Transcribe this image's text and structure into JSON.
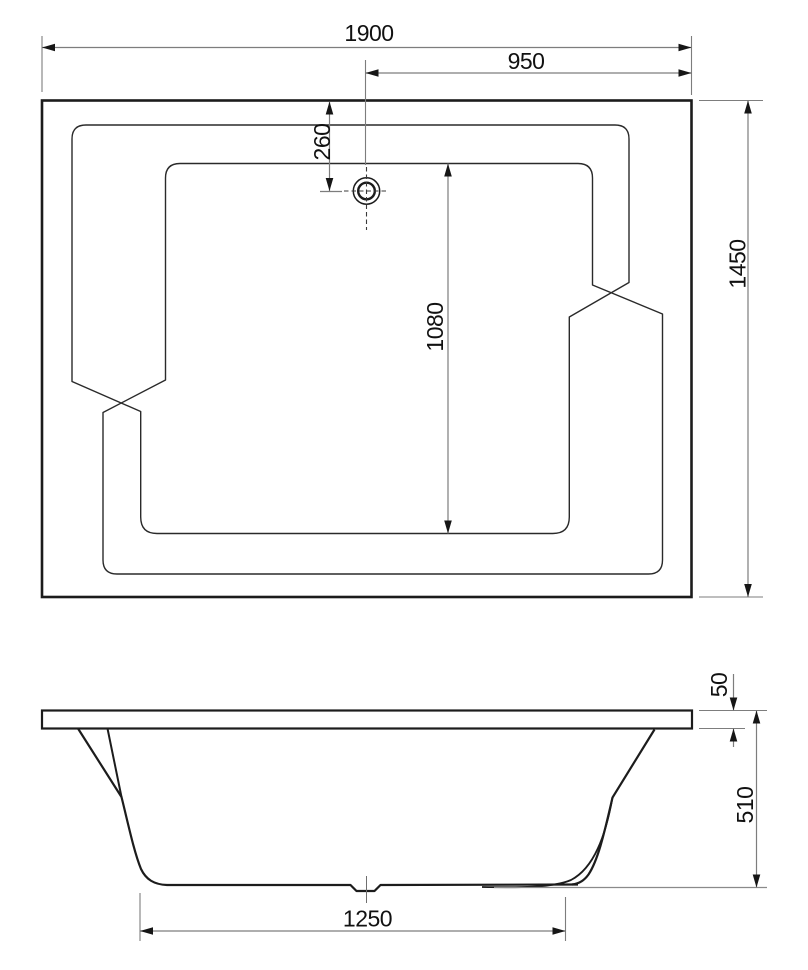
{
  "drawing": {
    "title": "bathtub-technical-drawing",
    "colors": {
      "background": "#ffffff",
      "outline_ink": "#1c1c1c",
      "contour_ink": "#2a2a2a",
      "dimension_line": "#7d7d7d",
      "text_ink": "#111111"
    },
    "top_view": {
      "dims": {
        "overall_length": "1900",
        "center_to_edge": "950",
        "edge_to_drain": "260",
        "basin_length": "1080",
        "overall_width": "1450"
      }
    },
    "side_view": {
      "dims": {
        "rim_thickness": "50",
        "body_height": "510",
        "bottom_length": "1250"
      }
    }
  }
}
